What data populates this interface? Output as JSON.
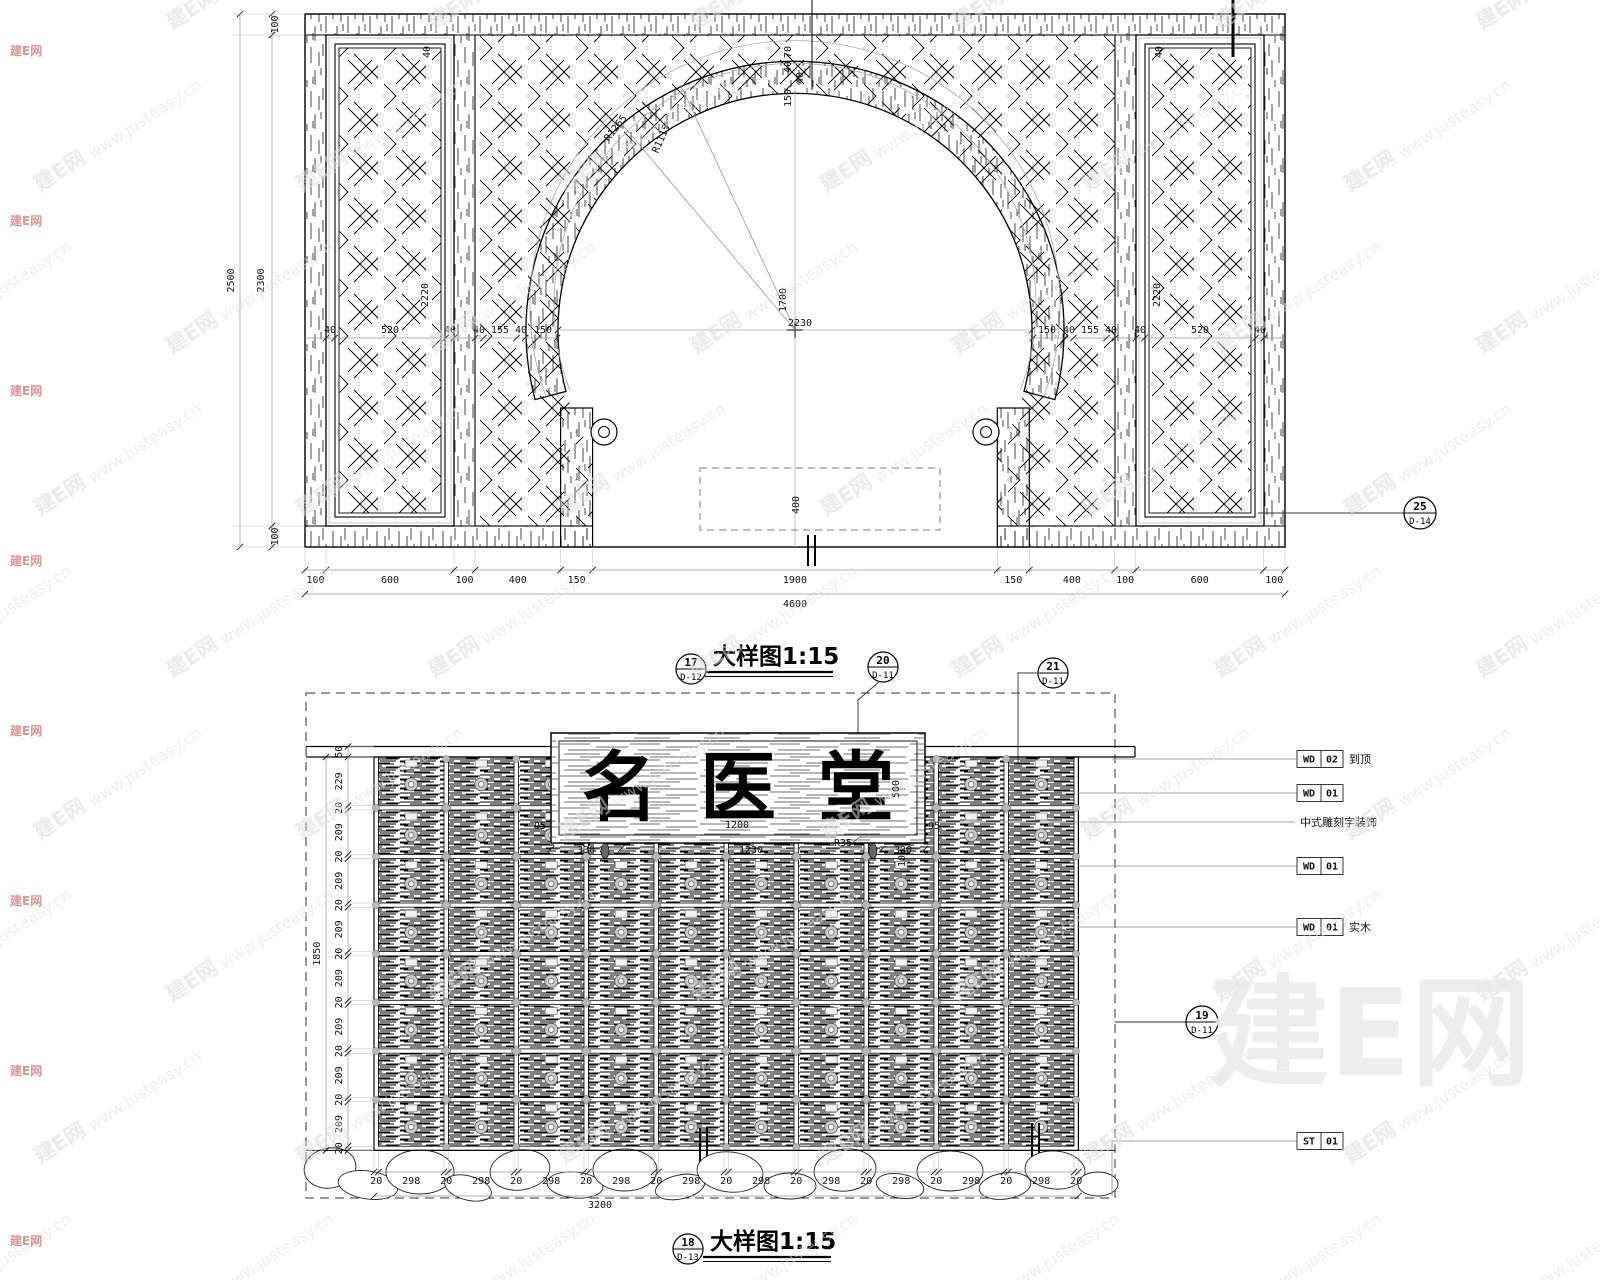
{
  "watermark": {
    "tile_cn": "建E网",
    "tile_url": "www.justeasy.cn",
    "logo": "建E网"
  },
  "top": {
    "title": "大样图1:15",
    "scale_marker": {
      "no": "17",
      "sheet": "D-12"
    },
    "marker20": {
      "no": "20",
      "sheet": "D-11"
    },
    "marker21": {
      "no": "21",
      "sheet": "D-11"
    },
    "ref_marker": {
      "no": "25",
      "sheet": "D-14"
    },
    "dims_bottom": [
      "100",
      "600",
      "100",
      "400",
      "150",
      "1900",
      "150",
      "400",
      "100",
      "600",
      "100"
    ],
    "total_bottom": "4600",
    "dims_mid_left": [
      "40",
      "520",
      "40"
    ],
    "dims_mid_left2": [
      "40",
      "155",
      "40",
      "150"
    ],
    "dims_mid_right2": [
      "150",
      "40",
      "155",
      "40"
    ],
    "dims_mid_right": [
      "40",
      "520",
      "40"
    ],
    "left_top": "100",
    "left_h1": "2500",
    "left_h2": "2300",
    "left_bottom": "100",
    "panel_inner_h": "2220",
    "panel_frame": "40",
    "apex": [
      "70",
      "40",
      "40",
      "150"
    ],
    "radius_outer": "R1265",
    "radius_inner": "R1115",
    "opening_w": "2230",
    "opening_center_h": "1700",
    "opening_base": "400"
  },
  "bottom": {
    "title": "大样图1:15",
    "scale_marker": {
      "no": "18",
      "sheet": "D-13"
    },
    "marker19": {
      "no": "19",
      "sheet": "D-11"
    },
    "sign_text": "名医堂",
    "band": "50",
    "left_chain": [
      "229",
      "20",
      "209",
      "20",
      "209",
      "20",
      "209",
      "20",
      "209",
      "20",
      "209",
      "20",
      "209",
      "20",
      "209",
      "20"
    ],
    "left_total": "1850",
    "dims_bottom": [
      "20",
      "298",
      "20",
      "298",
      "20",
      "298",
      "20",
      "298",
      "20",
      "298",
      "20",
      "298",
      "20",
      "298",
      "20",
      "298",
      "20",
      "298",
      "20",
      "298",
      "20"
    ],
    "bottom_total": "3200",
    "sign_dims": {
      "side_l": "95",
      "side_r": "95",
      "seg1": "330",
      "seg2": "1230",
      "rad": "R35",
      "seg3": "330",
      "inner_w": "1200",
      "h": "500",
      "h2": "100"
    },
    "materials": [
      {
        "c1": "WD",
        "c2": "02",
        "note": "到顶"
      },
      {
        "c1": "WD",
        "c2": "01",
        "note": ""
      },
      {
        "c1": "",
        "c2": "",
        "note": "中式雕刻字装饰"
      },
      {
        "c1": "WD",
        "c2": "01",
        "note": ""
      },
      {
        "c1": "WD",
        "c2": "01",
        "note": "实木"
      },
      {
        "c1": "ST",
        "c2": "01",
        "note": ""
      }
    ]
  }
}
